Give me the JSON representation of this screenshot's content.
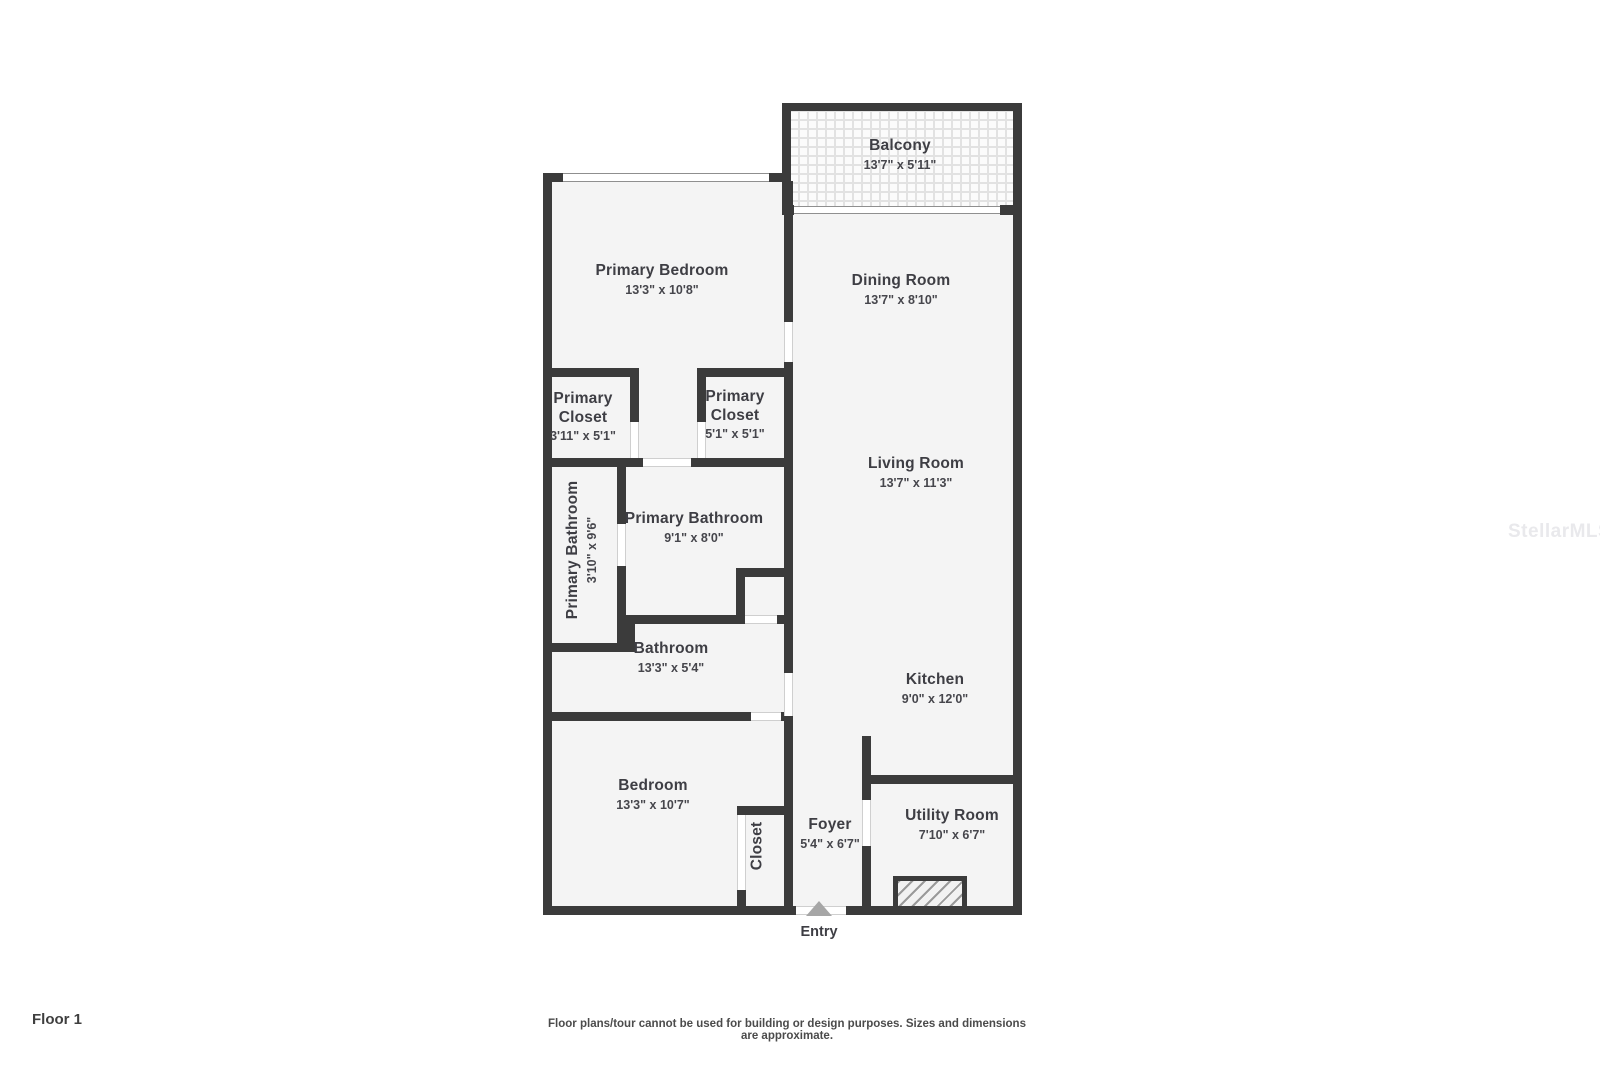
{
  "watermark": "StellarMLS",
  "floor_label": "Floor 1",
  "disclaimer": "Floor plans/tour cannot be used for building or design purposes. Sizes and dimensions are approximate.",
  "entry_label": "Entry",
  "rooms": [
    {
      "name": "Balcony",
      "dims": "13'7\" x 5'11\""
    },
    {
      "name": "Primary Bedroom",
      "dims": "13'3\" x 10'8\""
    },
    {
      "name": "Dining Room",
      "dims": "13'7\" x 8'10\""
    },
    {
      "name": "Primary Closet",
      "dims": "3'11\" x 5'1\""
    },
    {
      "name": "Primary Closet",
      "dims": "5'1\" x 5'1\""
    },
    {
      "name": "Primary Bathroom",
      "dims": "3'10\" x 9'6\""
    },
    {
      "name": "Primary Bathroom",
      "dims": "9'1\" x 8'0\""
    },
    {
      "name": "Living Room",
      "dims": "13'7\" x 11'3\""
    },
    {
      "name": "Bathroom",
      "dims": "13'3\" x 5'4\""
    },
    {
      "name": "Kitchen",
      "dims": "9'0\" x 12'0\""
    },
    {
      "name": "Bedroom",
      "dims": "13'3\" x 10'7\""
    },
    {
      "name": "Closet",
      "dims": ""
    },
    {
      "name": "Foyer",
      "dims": "5'4\" x 6'7\""
    },
    {
      "name": "Utility Room",
      "dims": "7'10\" x 6'7\""
    }
  ],
  "colors": {
    "wall": "#3b3b3b",
    "room_fill": "#f4f4f4",
    "text": "#3e3e44",
    "entry_arrow": "#a6a6a6"
  }
}
